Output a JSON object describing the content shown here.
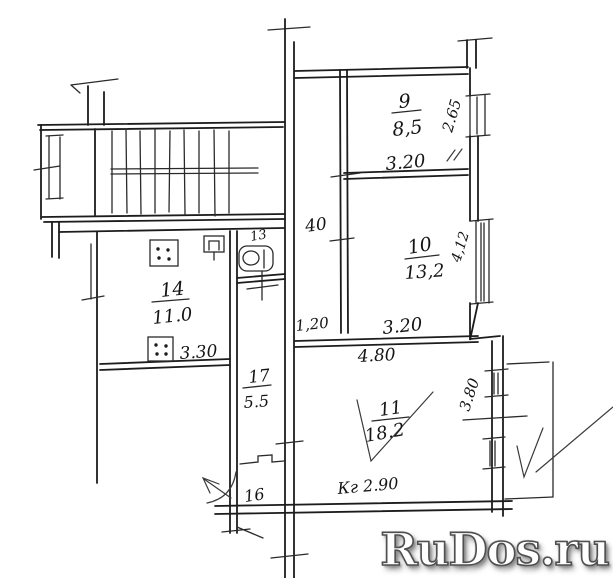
{
  "watermark": {
    "text": "RuDos.ru"
  },
  "rooms": [
    {
      "number": "9",
      "area": "8,5"
    },
    {
      "number": "10",
      "area": "13,2"
    },
    {
      "number": "11",
      "area": "18.2"
    },
    {
      "number": "14",
      "area": "11.0"
    },
    {
      "number": "17",
      "area": "5.5"
    },
    {
      "number": "13"
    },
    {
      "number": "16"
    }
  ],
  "dimensions": {
    "room9_width": "3.20",
    "room9_height": "2.65",
    "corridor_width": "40",
    "room10_width": "3.20",
    "room10_height": "4,12",
    "hall_width": "1,20",
    "room11_width": "4.80",
    "room11_height": "3.80",
    "room14_width": "3.30",
    "ceiling_note": "Кг 2.90"
  }
}
